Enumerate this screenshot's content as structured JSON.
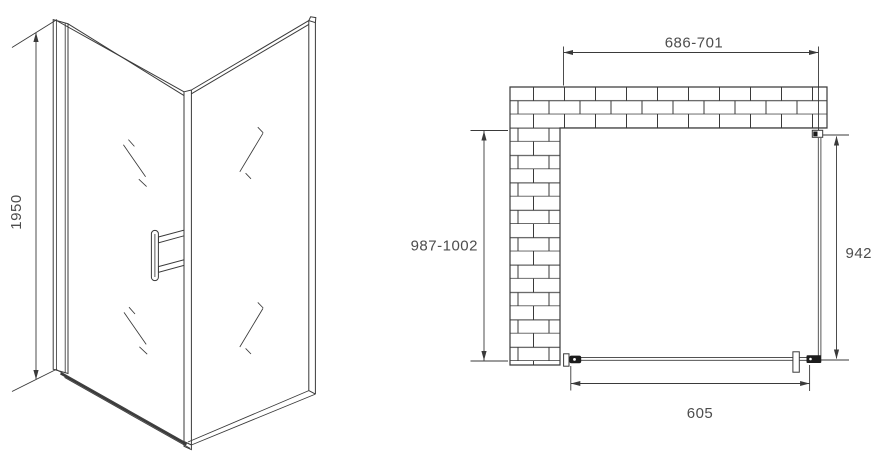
{
  "drawing": {
    "type": "shower-enclosure-technical-drawing",
    "views": {
      "front_view": {
        "description": "corner shower enclosure perspective view with door handle",
        "height_dim": "1950"
      },
      "plan_view": {
        "description": "top plan view with L-shaped brick wall",
        "top_width_dim": "686-701",
        "wall_depth_dim": "987-1002",
        "side_glass_dim": "942",
        "door_width_dim": "605"
      }
    }
  },
  "colors": {
    "line": "#3a3a3a",
    "text": "#4d4d4d",
    "fill_dark": "#1c1c1c",
    "background": "#ffffff"
  }
}
